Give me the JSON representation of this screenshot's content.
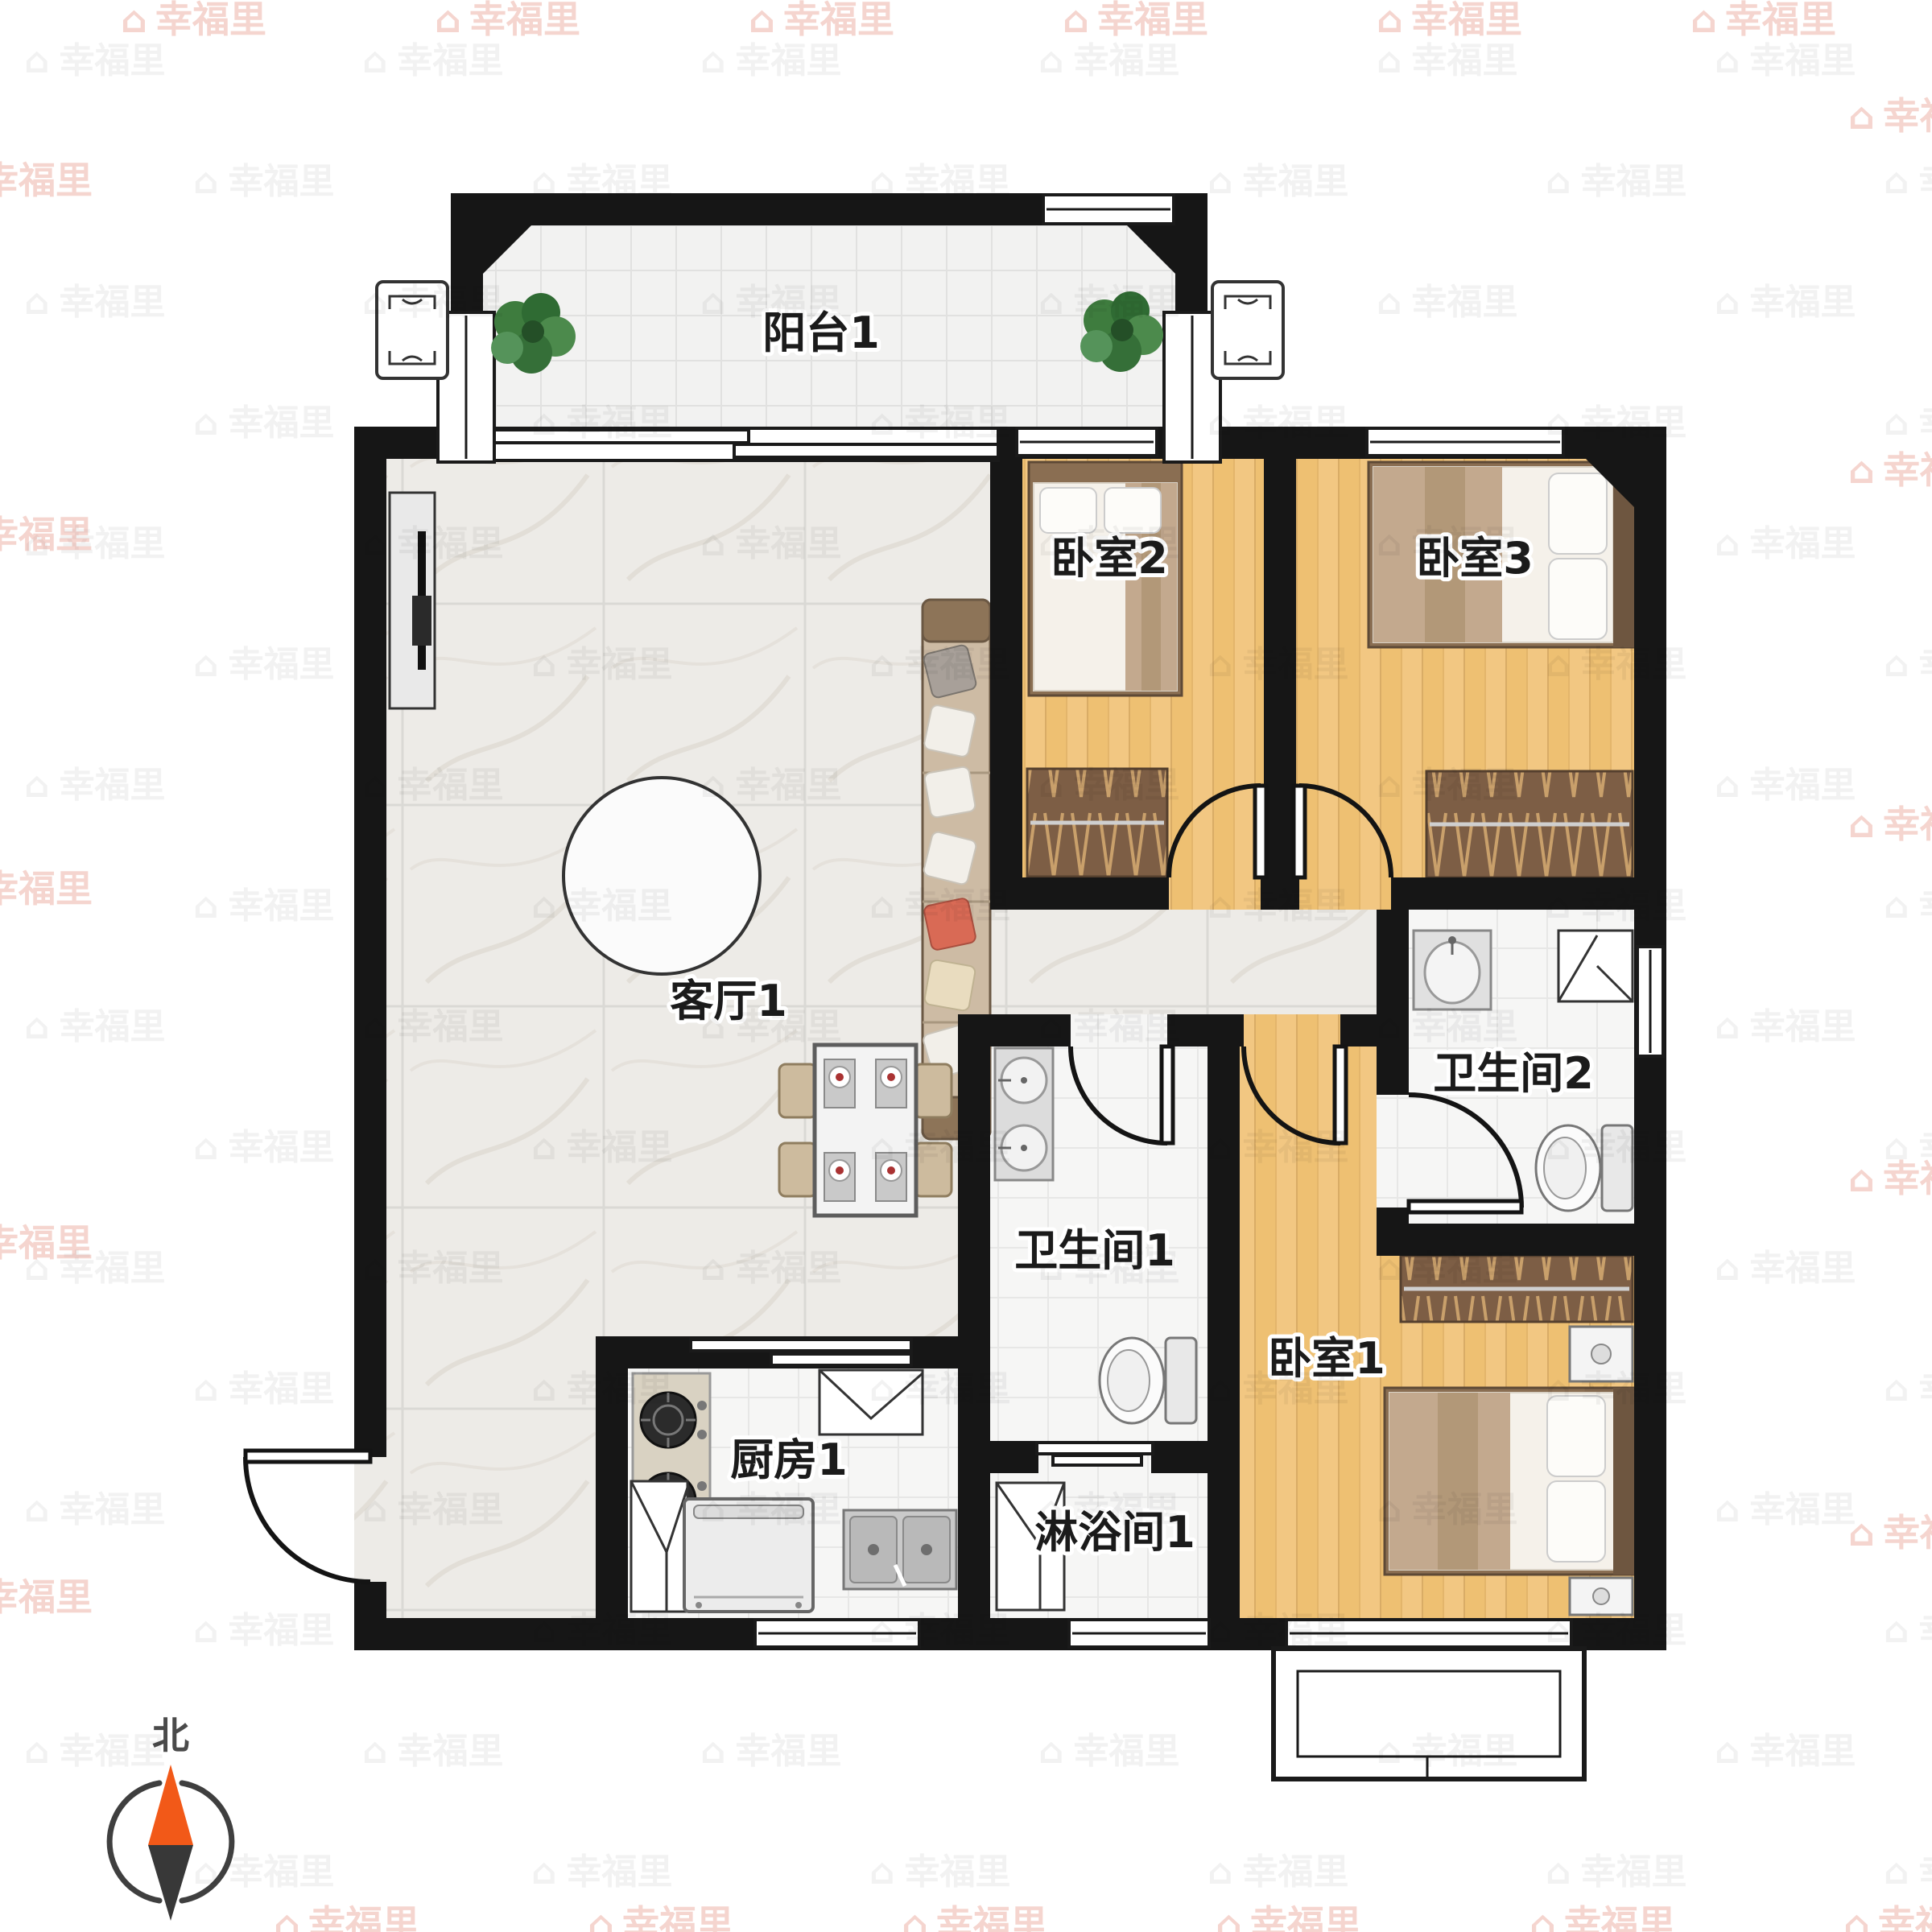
{
  "page": {
    "type": "residential-floor-plan",
    "brand": "幸福里"
  },
  "rooms": [
    {
      "id": "balcony-1",
      "label": "阳台1"
    },
    {
      "id": "bedroom-2",
      "label": "卧室2"
    },
    {
      "id": "bedroom-3",
      "label": "卧室3"
    },
    {
      "id": "living-room-1",
      "label": "客厅1"
    },
    {
      "id": "bathroom-2",
      "label": "卫生间2"
    },
    {
      "id": "bathroom-1",
      "label": "卫生间1"
    },
    {
      "id": "bedroom-1",
      "label": "卧室1"
    },
    {
      "id": "kitchen-1",
      "label": "厨房1"
    },
    {
      "id": "shower-room-1",
      "label": "淋浴间1"
    }
  ],
  "compass": {
    "north_label": "北"
  },
  "watermark": {
    "icon": "⌂",
    "text": "幸福里"
  },
  "colors": {
    "wall": "#161616",
    "wood_floor": "#f2c782",
    "marble_floor": "#edebe7",
    "tile_floor": "#f6f6f5",
    "wardrobe": "#7d5e45",
    "sofa": "#cdbba4",
    "compass_north": "#f25918",
    "watermark_pink": "#d9604a"
  }
}
